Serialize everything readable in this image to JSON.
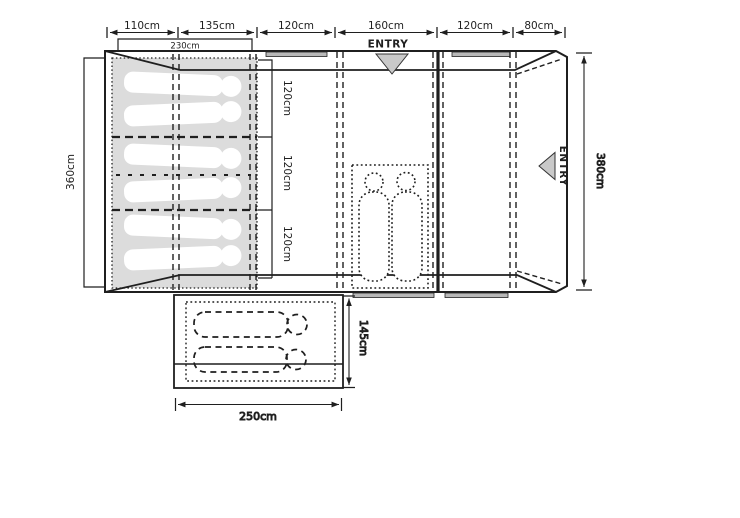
{
  "diagram": {
    "type": "tent-floorplan",
    "top_dimensions": [
      "110cm",
      "135cm",
      "120cm",
      "160cm",
      "120cm",
      "80cm"
    ],
    "bedroom_width": "230cm",
    "left_height": "360cm",
    "berth_sections": [
      "120cm",
      "120cm",
      "120cm"
    ],
    "right_height": "380cm",
    "canopy_depth": "145cm",
    "canopy_width": "250cm",
    "entry_top_label": "ENTRY",
    "entry_side_label": "ENTRY",
    "colors": {
      "line": "#1f1f1f",
      "sleep_area": "#dcdcdc",
      "entry_marker": "#c9c9c9",
      "window_bar": "#b8b8b8"
    }
  }
}
